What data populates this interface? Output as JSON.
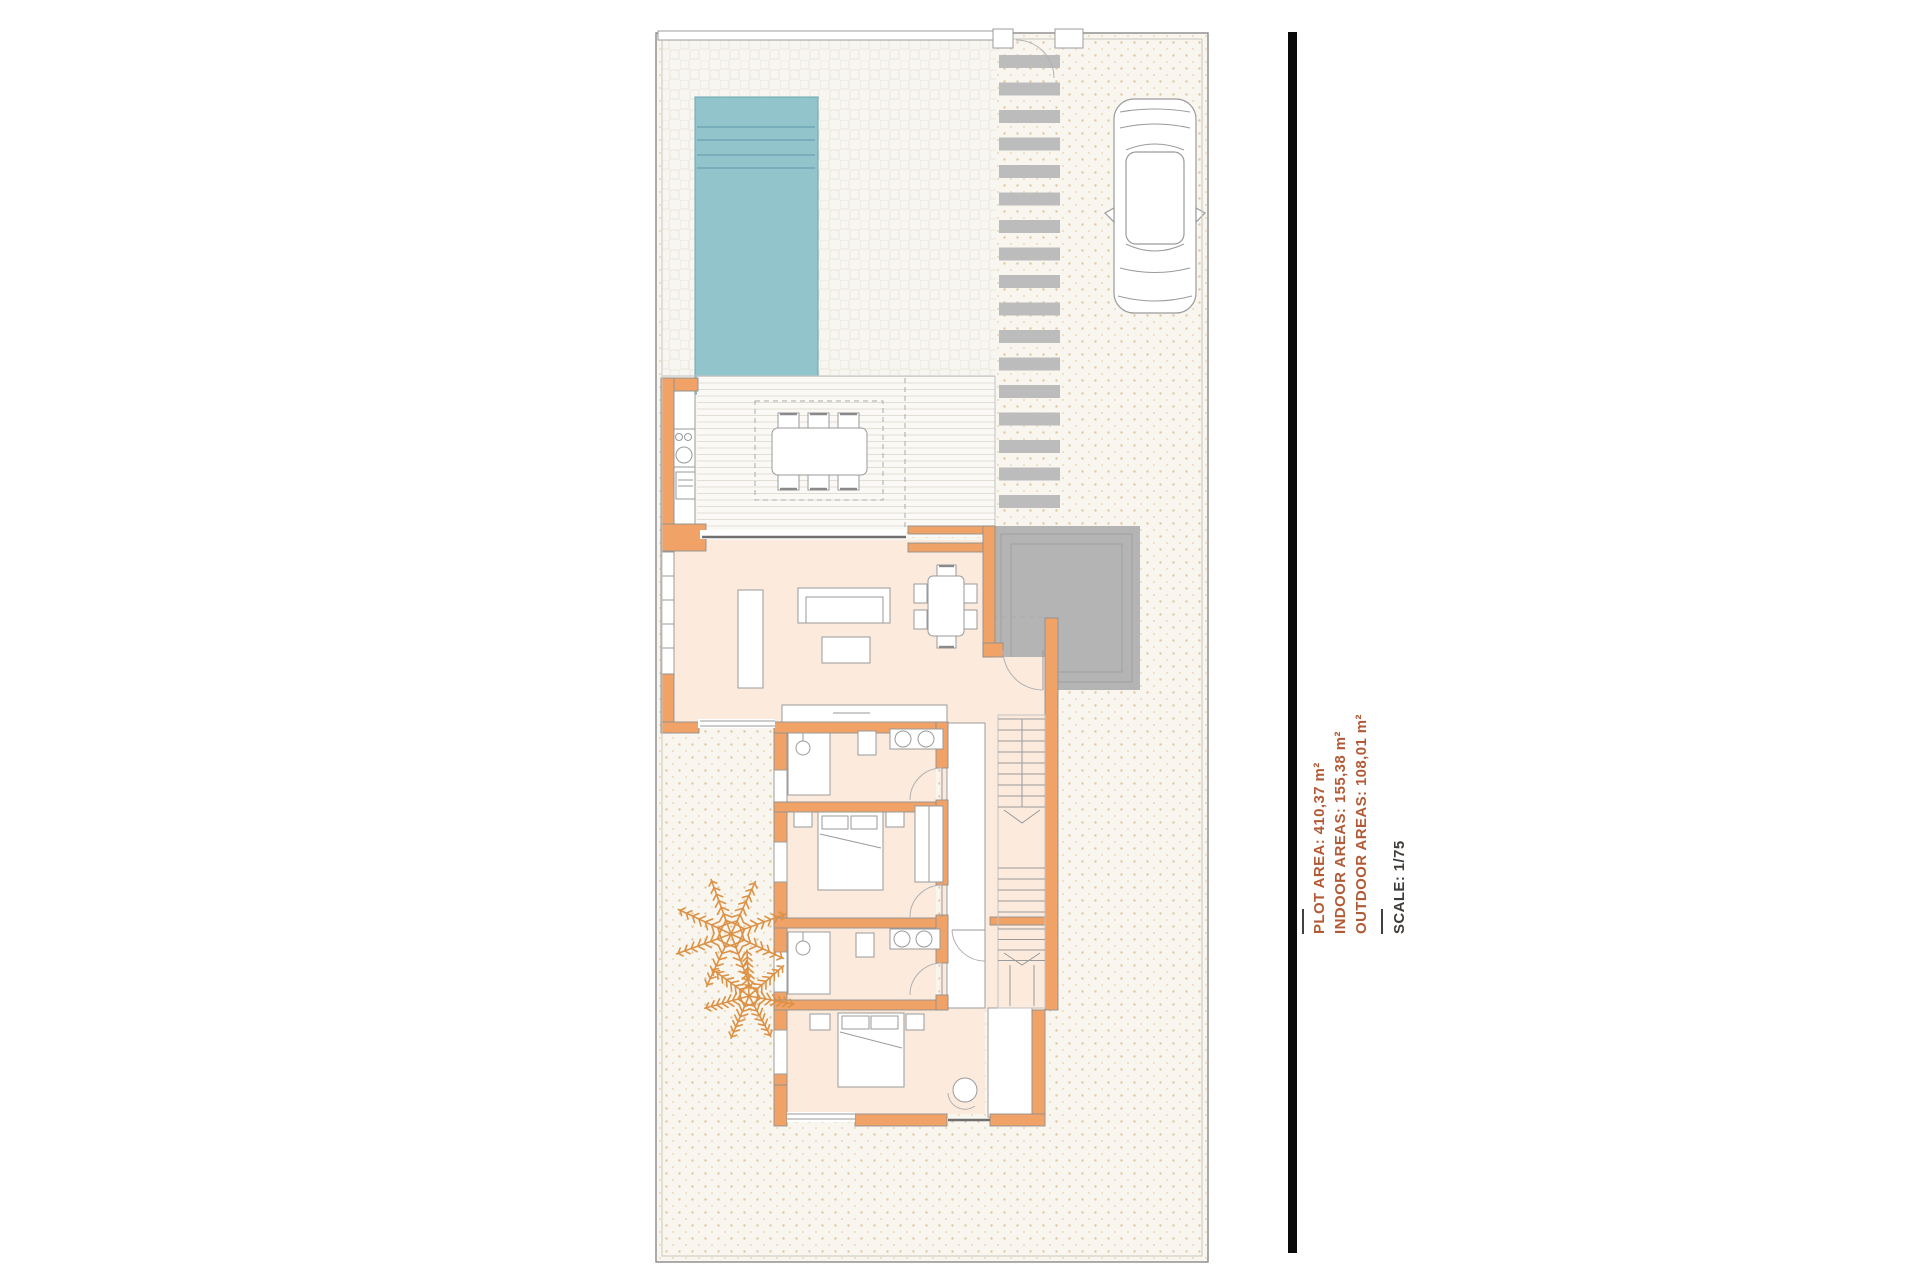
{
  "annotations": {
    "plot_area": "PLOT AREA: 410,37 m²",
    "indoor_areas": "INDOOR AREAS: 155,38 m²",
    "outdoor_areas": "OUTDOOR AREAS: 108,01 m²",
    "scale": "SCALE: 1/75"
  },
  "colors": {
    "annotation_accent": "#b25a36",
    "annotation_scale": "#3f3b38",
    "wall_orange": "#f1a266",
    "floor_peach": "#fcebdd",
    "pool_teal": "#92c4cc",
    "paving_gray": "#bcbcbc",
    "patio_gray": "#b4b4b4",
    "palm_orange": "#dd9145",
    "sidebar_black": "#0a0a0a"
  }
}
